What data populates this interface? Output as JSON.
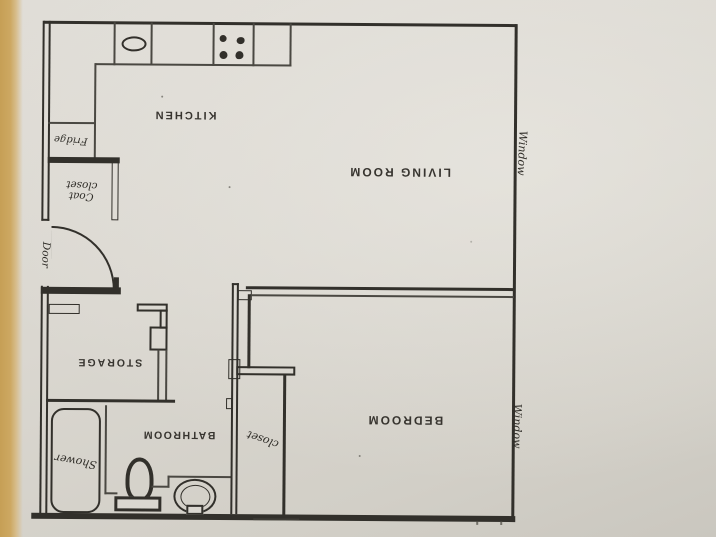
{
  "floor_plan": {
    "type": "apartment-floor-plan-photo",
    "orientation": "plan photographed upside down; printed labels appear rotated 180°",
    "rooms": {
      "kitchen": "KITCHEN",
      "living_room": "LIVING ROOM",
      "bedroom": "BEDROOM",
      "bathroom": "BATHROOM",
      "storage": "STORAGE"
    },
    "handwritten": {
      "fridge": "Fridge",
      "coat_closet_line1": "Coat",
      "coat_closet_line2": "closet",
      "door": "Door",
      "window_living_room": "Window",
      "window_bedroom": "Window",
      "bedroom_closet": "closet",
      "shower": "Shower"
    },
    "fixtures": [
      "kitchen-sink",
      "stove-burners",
      "refrigerator",
      "kitchen-counter",
      "entry-door-arc",
      "shower-tub",
      "toilet",
      "bathroom-sink",
      "storage-door-leaf"
    ],
    "colors": {
      "paper": "#dad7d0",
      "table_edge": "#cda765",
      "ink": "#32302b"
    }
  }
}
